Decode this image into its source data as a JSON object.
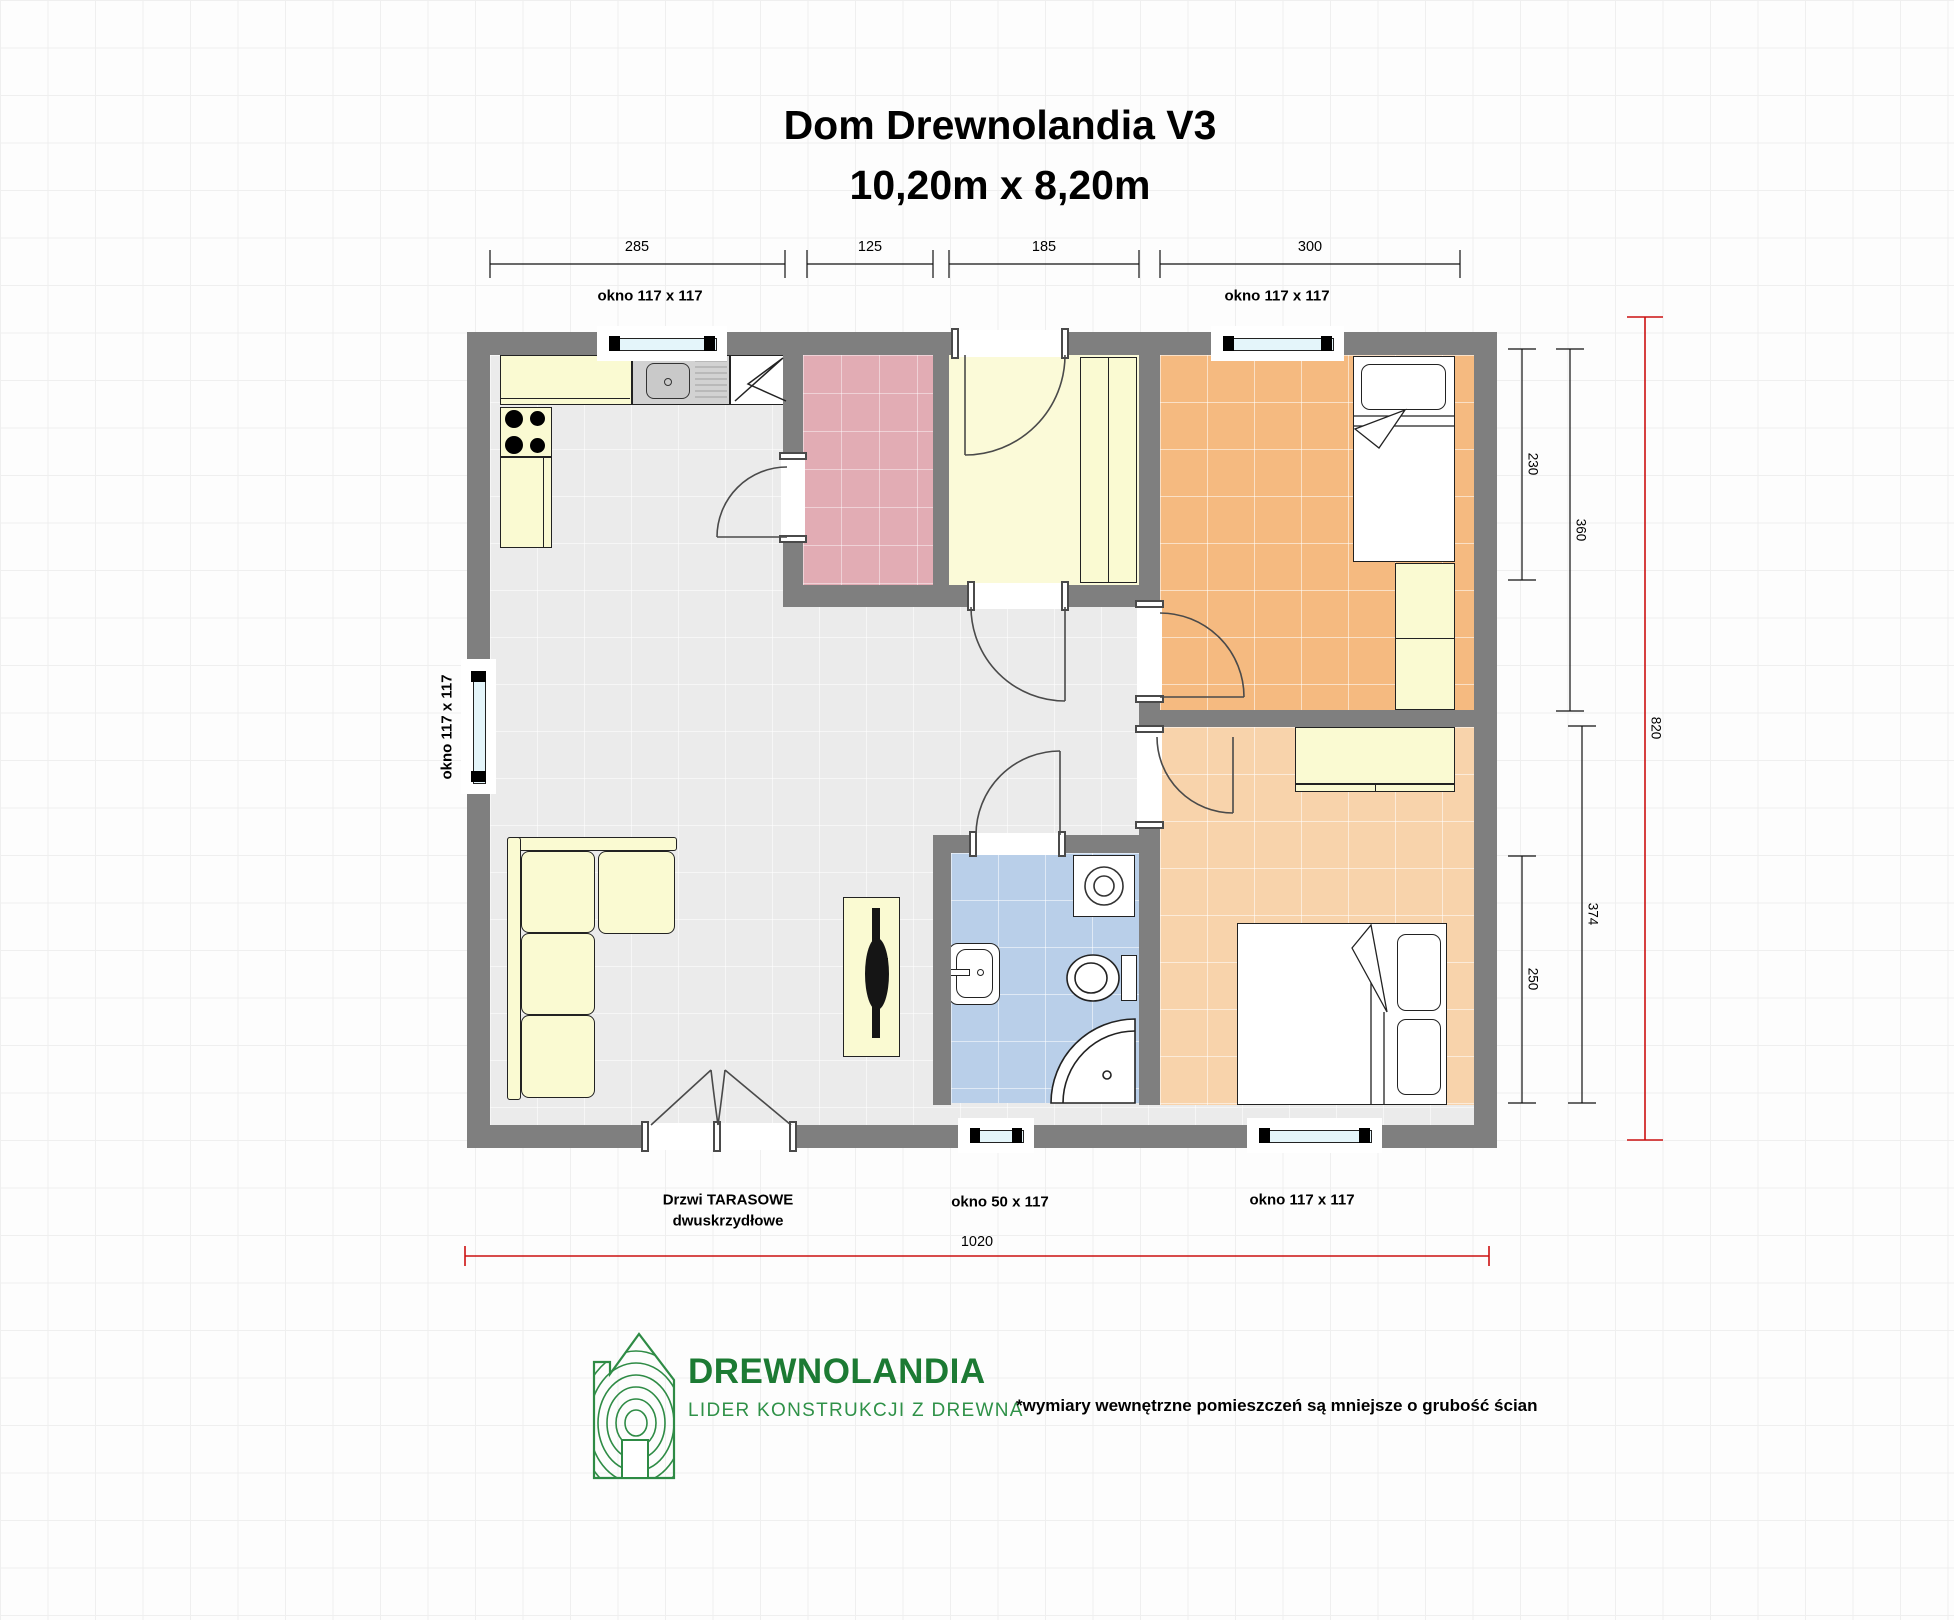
{
  "title": {
    "line1": "Dom Drewnolandia V3",
    "line2": "10,20m x 8,20m"
  },
  "dims": {
    "top": [
      "285",
      "125",
      "185",
      "300"
    ],
    "right": [
      "230",
      "360",
      "820",
      "374",
      "250"
    ],
    "bottom": "1020"
  },
  "windows": {
    "top_left": "okno 117 x 117",
    "top_right": "okno 117 x 117",
    "left": "okno 117 x 117",
    "bottom_small": "okno 50 x 117",
    "bottom_right": "okno 117 x 117"
  },
  "terrace_door": {
    "line1": "Drzwi TARASOWE",
    "line2": "dwuskrzydłowe"
  },
  "footer": {
    "brand": "DREWNOLANDIA",
    "tagline": "LIDER KONSTRUKCJI Z DREWNA",
    "note": "*wymiary wewnętrzne pomieszczeń są mniejsze o grubość ścian"
  },
  "colors": {
    "wall": "#7f7f7f",
    "floor": "#ebebeb",
    "furniture_yellow": "#fafad2",
    "room_pink": "#e2acb4",
    "room_entry_yellow": "#fbfad8",
    "bedroom_orange": "#f5ba80",
    "bedroom_peach": "#f8d3ab",
    "bathroom_blue": "#b9cfe9",
    "dimension_red": "#cc1111",
    "logo_green": "#2e8b45",
    "window_glass": "#e4f5fa"
  }
}
